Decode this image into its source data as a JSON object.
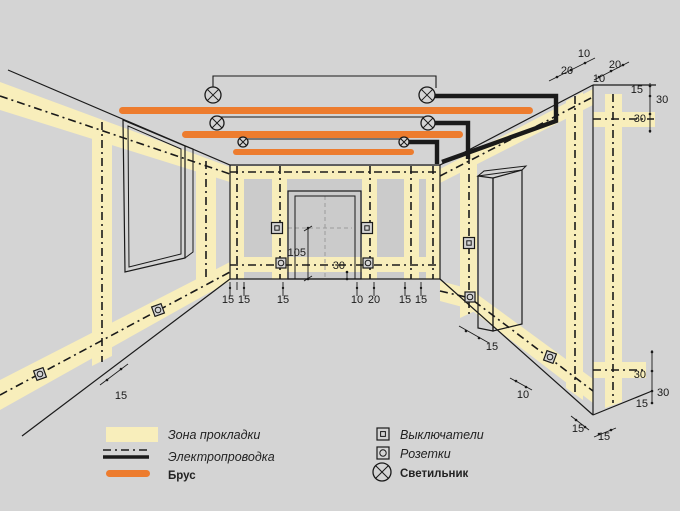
{
  "colors": {
    "background": "#d4d4d4",
    "panel": "#cbcbcb",
    "zone": "#f8eebb",
    "beam": "#ed7c2e",
    "ink": "#1a1a1a"
  },
  "legend": {
    "zone": "Зона прокладки",
    "wiring": "Электропроводка",
    "beam": "Брус",
    "switches": "Выключатели",
    "outlets": "Розетки",
    "lamp": "Светильник"
  },
  "dims": [
    "10",
    "20",
    "20",
    "10",
    "15",
    "30",
    "30",
    "105",
    "30",
    "15",
    "15",
    "15",
    "10",
    "20",
    "15",
    "15",
    "15",
    "15",
    "10",
    "15",
    "15",
    "30",
    "30",
    "15"
  ]
}
